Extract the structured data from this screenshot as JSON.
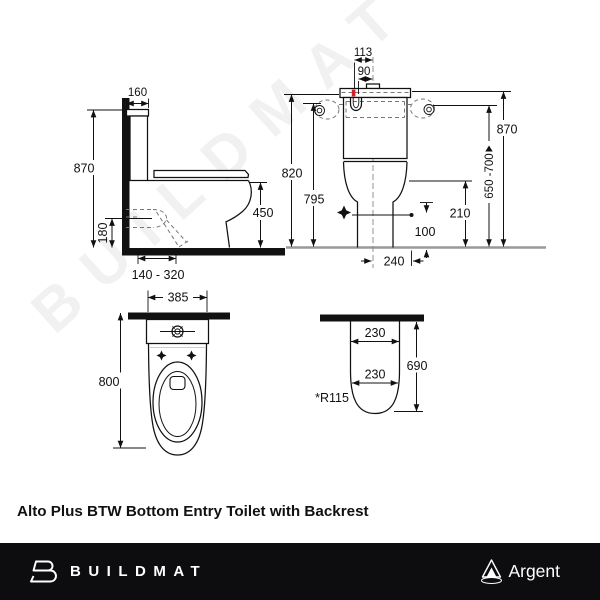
{
  "product": {
    "title": "Alto Plus BTW Bottom Entry Toilet with Backrest"
  },
  "watermark": {
    "text": "BUILDMAT"
  },
  "footer": {
    "brand": "BUILDMAT",
    "partner": "Argent"
  },
  "views": {
    "side": {
      "dims": {
        "cistern_depth": "160",
        "overall_height": "870",
        "trap_height": "180",
        "rim_height": "450",
        "setout_range": "140 - 320"
      }
    },
    "rear": {
      "dims": {
        "lid_width": "113",
        "inlet_width": "90",
        "height_lid": "820",
        "height_inlet_line": "795",
        "overall_height": "870",
        "inlet_range": "650 -700",
        "rim_clearance": "210",
        "inlet_clearance": "100",
        "base_width": "240"
      }
    },
    "plan": {
      "dims": {
        "overall_width": "385",
        "overall_depth": "800"
      }
    },
    "footprint": {
      "dims": {
        "width_upper": "230",
        "width_lower": "230",
        "depth": "690",
        "radius": "*R115"
      }
    }
  }
}
